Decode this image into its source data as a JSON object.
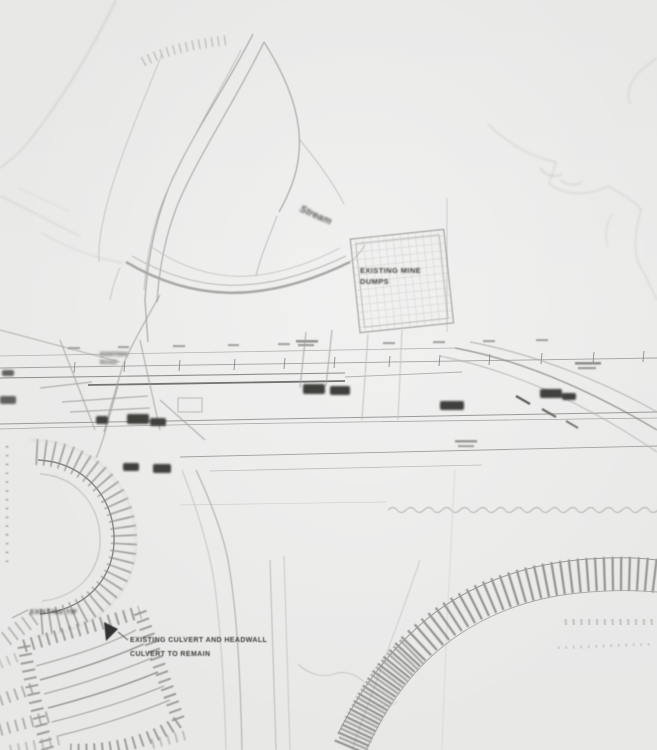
{
  "page": {
    "kind": "scanned engineering site plan (low-resolution photocopy)",
    "palette": {
      "paper": "#e9e9e8",
      "line_faint": "#c6c6c4",
      "line_medium": "#9a9a98",
      "line_dark": "#3c3c3a",
      "hatch": "#8a8a88"
    }
  },
  "labels": {
    "stream_note": "Stream",
    "dump_area": {
      "line1": "EXISTING MINE",
      "line2": "DUMPS"
    },
    "junction_note": {
      "line1": "EXISTING",
      "line2": "ROAD"
    },
    "tip_note": "EXISTING TIP",
    "culvert_note": {
      "line1": "EXISTING CULVERT AND HEADWALL",
      "line2": "CULVERT TO REMAIN"
    }
  }
}
